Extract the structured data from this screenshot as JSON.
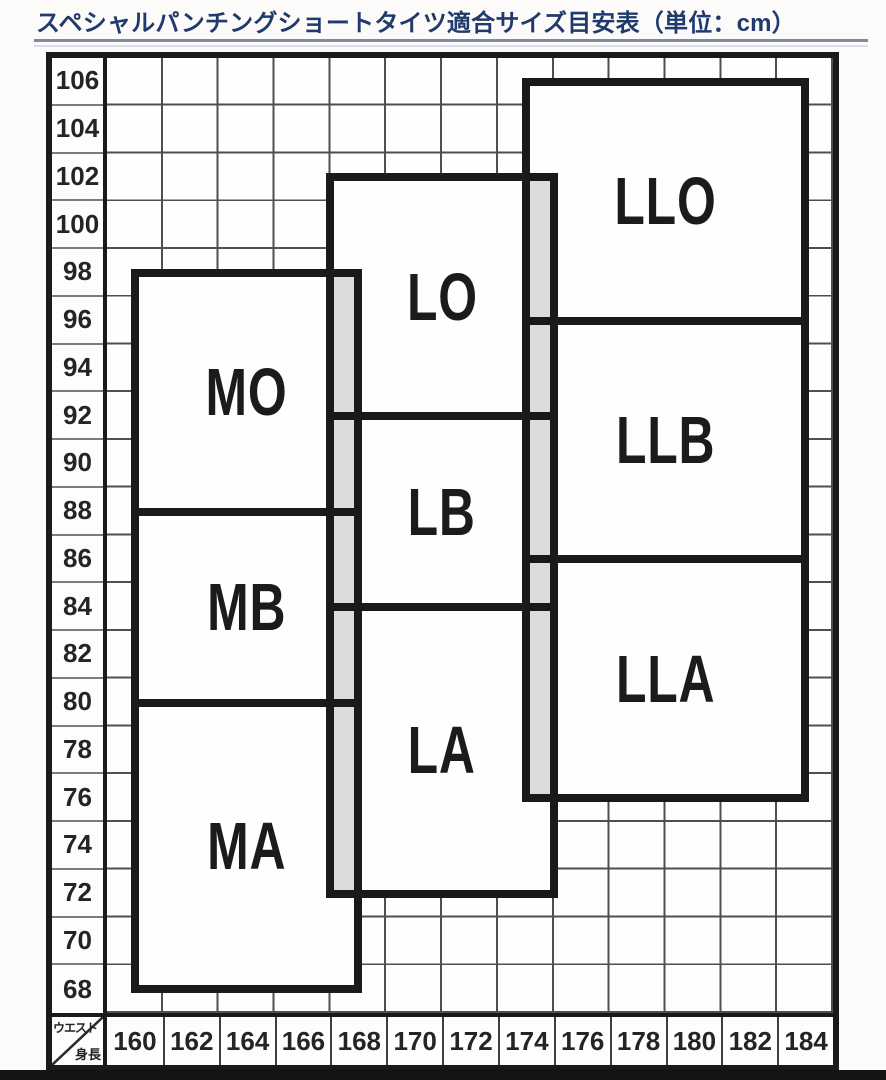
{
  "title": "スペシャルパンチングショートタイツ適合サイズ目安表（単位：cm）",
  "chart_data": {
    "type": "area",
    "title": "スペシャルパンチングショートタイツ適合サイズ目安表",
    "unit": "cm",
    "grid": true,
    "x_axis": {
      "label": "身長",
      "ticks": [
        160,
        162,
        164,
        166,
        168,
        170,
        172,
        174,
        176,
        178,
        180,
        182,
        184
      ]
    },
    "y_axis": {
      "label": "ウエスト",
      "ticks": [
        106,
        104,
        102,
        100,
        98,
        96,
        94,
        92,
        90,
        88,
        86,
        84,
        82,
        80,
        78,
        76,
        74,
        72,
        70,
        68
      ]
    },
    "corner_labels": {
      "top": "ウエスト",
      "bottom": "身長"
    },
    "regions": [
      {
        "label": "MO",
        "height_range": [
          160,
          168
        ],
        "waist_range": [
          88,
          98
        ]
      },
      {
        "label": "MB",
        "height_range": [
          160,
          168
        ],
        "waist_range": [
          80,
          88
        ]
      },
      {
        "label": "MA",
        "height_range": [
          160,
          168
        ],
        "waist_range": [
          68,
          80
        ]
      },
      {
        "label": "LO",
        "height_range": [
          167,
          175
        ],
        "waist_range": [
          92,
          102
        ]
      },
      {
        "label": "LB",
        "height_range": [
          167,
          175
        ],
        "waist_range": [
          84,
          92
        ]
      },
      {
        "label": "LA",
        "height_range": [
          167,
          175
        ],
        "waist_range": [
          72,
          84
        ]
      },
      {
        "label": "LLO",
        "height_range": [
          174,
          184
        ],
        "waist_range": [
          96,
          106
        ]
      },
      {
        "label": "LLB",
        "height_range": [
          174,
          184
        ],
        "waist_range": [
          86,
          96
        ]
      },
      {
        "label": "LLA",
        "height_range": [
          174,
          184
        ],
        "waist_range": [
          76,
          86
        ]
      }
    ],
    "overlap_bands": [
      {
        "between": [
          "M",
          "L"
        ],
        "height_range": [
          167,
          168
        ],
        "waist_range": [
          72,
          98
        ]
      },
      {
        "between": [
          "L",
          "LL"
        ],
        "height_range": [
          174,
          175
        ],
        "waist_range": [
          76,
          102
        ]
      }
    ]
  },
  "colors": {
    "title_text": "#203a6e",
    "divider_line": "#7e8b9f",
    "box_border": "#1a1a1a",
    "grid_line": "#4f4f4f",
    "overlap_fill": "#dcdcda",
    "background": "#fcfbf9",
    "axis_text": "#242424",
    "bottom_bar": "#141414"
  }
}
